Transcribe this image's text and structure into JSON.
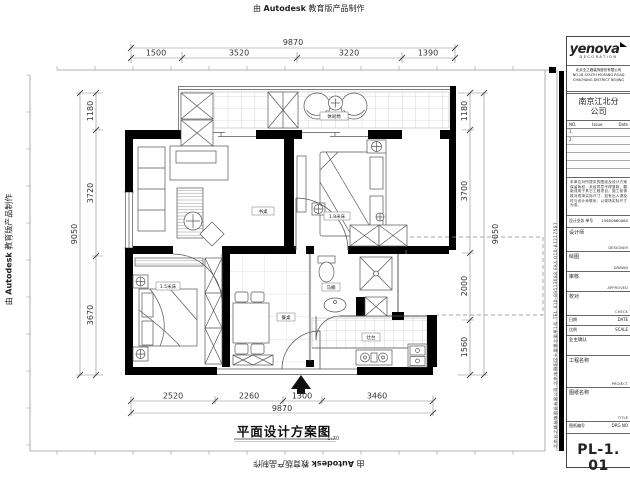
{
  "watermark": {
    "prefix": "由",
    "brand": "Autodesk",
    "suffix": "教育版产品制作"
  },
  "plan": {
    "title": "平面设计方案图",
    "scale_text": "1:70",
    "labels": {
      "balcony": "休闲椅",
      "study": "书桌",
      "master_bed": "1.8米床",
      "bed2": "1.5米床",
      "dining": "餐桌",
      "bath": "马桶",
      "kitchen": "灶台"
    }
  },
  "dims": {
    "top": {
      "total": "9870",
      "segments": [
        "1500",
        "3520",
        "3220",
        "1390"
      ]
    },
    "bottom": {
      "total": "9870",
      "segments": [
        "2520",
        "2260",
        "1300",
        "3460"
      ]
    },
    "left": {
      "total": "9050",
      "segments": [
        "1180",
        "3720",
        "3670"
      ]
    },
    "right": {
      "total": "9050",
      "segments": [
        "1180",
        "3700",
        "2000",
        "1560"
      ]
    }
  },
  "titleblock": {
    "logo": {
      "text": "yenova",
      "sub": "DECORATION"
    },
    "company": [
      "北京业之峰装饰股份有限公司",
      "NO.18 SOUTH MOFANG ROAD",
      "CHAOYANG DISTRICT BEIJING"
    ],
    "branch": "南京江北分公司",
    "issue": {
      "no": "NO.",
      "issue": "Issue",
      "date": "Date",
      "rows": [
        "1.",
        "2."
      ]
    },
    "notes": "本单位对所提供的图纸及设计方案保留版权，未经同意不得复制、翻版或用于其它工程项目。施工前请核对现场实际尺寸，如有出入请及时与设计师联系，以现场实际尺寸为准。",
    "design_no": {
      "label": "设计业务 单号",
      "value": "15650660080"
    },
    "designer": {
      "label": "设计师",
      "value": "DESIGNER"
    },
    "drawn": {
      "label": "绘图",
      "value": "DRAWN"
    },
    "approved": {
      "label": "审核",
      "value": "APPROVED"
    },
    "check": {
      "label": "校对",
      "value": "CHECK"
    },
    "date": {
      "label": "日期",
      "value": "DATE"
    },
    "scale": {
      "label": "比例",
      "value": "SCALE"
    },
    "owner": {
      "label": "业主确认"
    },
    "project": {
      "label": "工程名称",
      "value": "PROJECT"
    },
    "sheet_title": {
      "label": "图纸名称",
      "value": "TITLE"
    },
    "drg_no": {
      "label": "图纸编号",
      "value": "DRG NO"
    },
    "sheet_number": "PL-1. 01"
  },
  "sidebar": {
    "company_info": "北京业之峰装饰股份有限公司  北京市朝阳区十里堡北里甲1号  TEL 010-89513688  FAX 010-87217587"
  }
}
